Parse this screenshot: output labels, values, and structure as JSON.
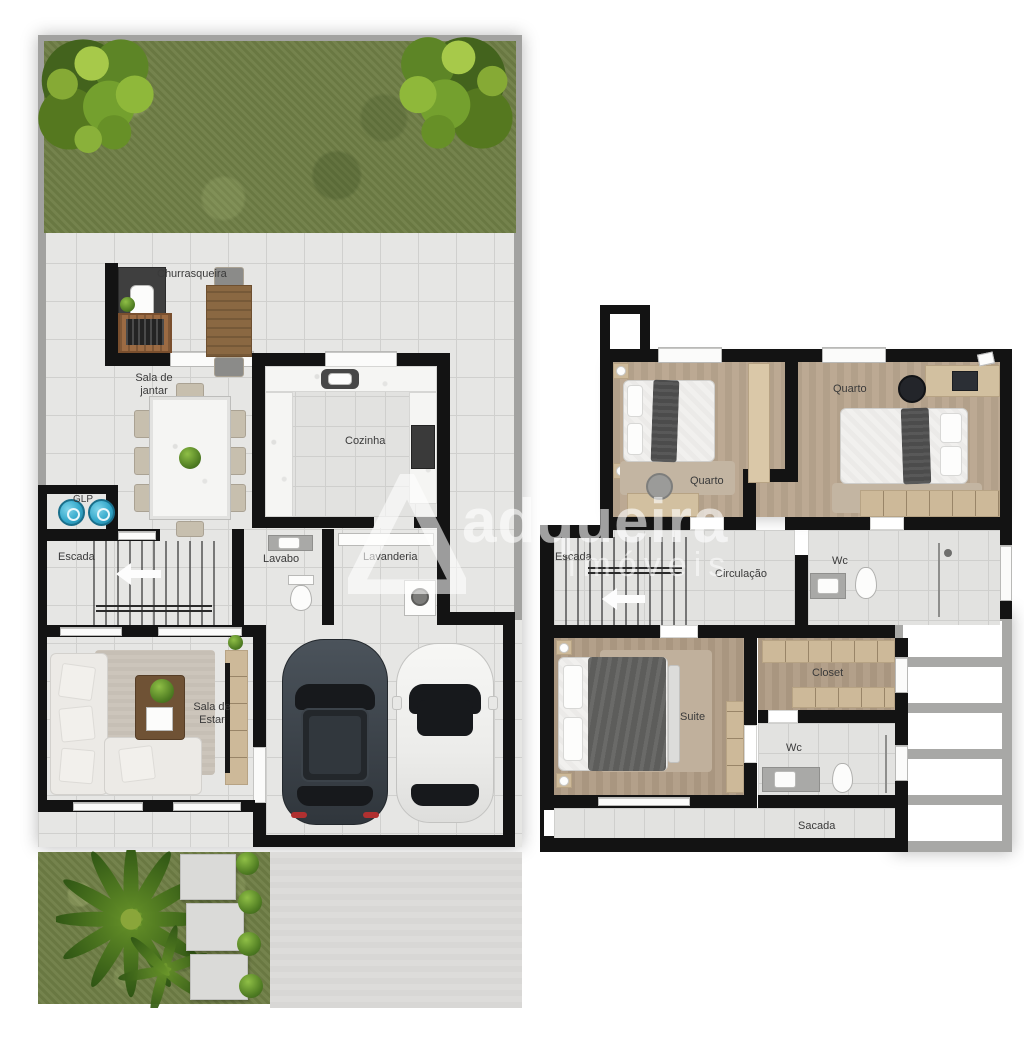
{
  "document": {
    "type": "floor-plan",
    "description": "Top-down 3D render floor plan of a two-story residence, ground floor on the left and upper floor on the right"
  },
  "watermark": {
    "logo": "triangle-a-logo",
    "brand": "adqueira",
    "subtitle": "imóveis"
  },
  "ground_floor": {
    "rooms": {
      "churrasqueira": "Churrasqueira",
      "sala_jantar": "Sala de jantar",
      "cozinha": "Cozinha",
      "glp": "GLP",
      "escada": "Escada",
      "lavabo": "Lavabo",
      "lavanderia": "Lavanderia",
      "sala_estar": "Sala de Estar"
    },
    "icons": [
      "tree-icon",
      "grass-yard",
      "barbecue-grill-icon",
      "outdoor-table-icon",
      "dining-table-icon",
      "kitchen-sink-icon",
      "oven-icon",
      "gas-cylinder-icon",
      "stairs-icon",
      "arrow-left-icon",
      "toilet-icon",
      "washbasin-icon",
      "washing-machine-icon",
      "sofa-icon",
      "rug-icon",
      "coffee-table-icon",
      "tv-panel-icon",
      "car-dark-icon",
      "car-white-icon",
      "palm-tree-icon",
      "stepping-stones-icon",
      "bush-icon",
      "driveway"
    ]
  },
  "upper_floor": {
    "rooms": {
      "quarto_1": "Quarto",
      "quarto_2": "Quarto",
      "escada": "Escada",
      "circulacao": "Circulação",
      "wc_1": "Wc",
      "closet": "Closet",
      "suite": "Suite",
      "wc_2": "Wc",
      "sacada": "Sacada"
    },
    "icons": [
      "single-bed-icon",
      "double-bed-icon",
      "desk-icon",
      "desk-chair-icon",
      "laptop-icon",
      "wardrobe-icon",
      "stairs-icon",
      "arrow-left-icon",
      "toilet-icon",
      "washbasin-icon",
      "closet-shelves-icon",
      "pergola-roof",
      "balcony"
    ]
  },
  "colors": {
    "wall": "#131313",
    "tile_floor": "#e6e6e4",
    "wood_floor": "#b9a68f",
    "grass": "#6f7e46",
    "lot_border": "#a2a2a0",
    "pergola_frame": "#a8a8a6",
    "furniture_wood": "#cdb999",
    "gas_cylinder_blue": "#35a9cb",
    "label_text": "#3a3a3a",
    "watermark": "rgba(255,255,255,0.6)"
  }
}
